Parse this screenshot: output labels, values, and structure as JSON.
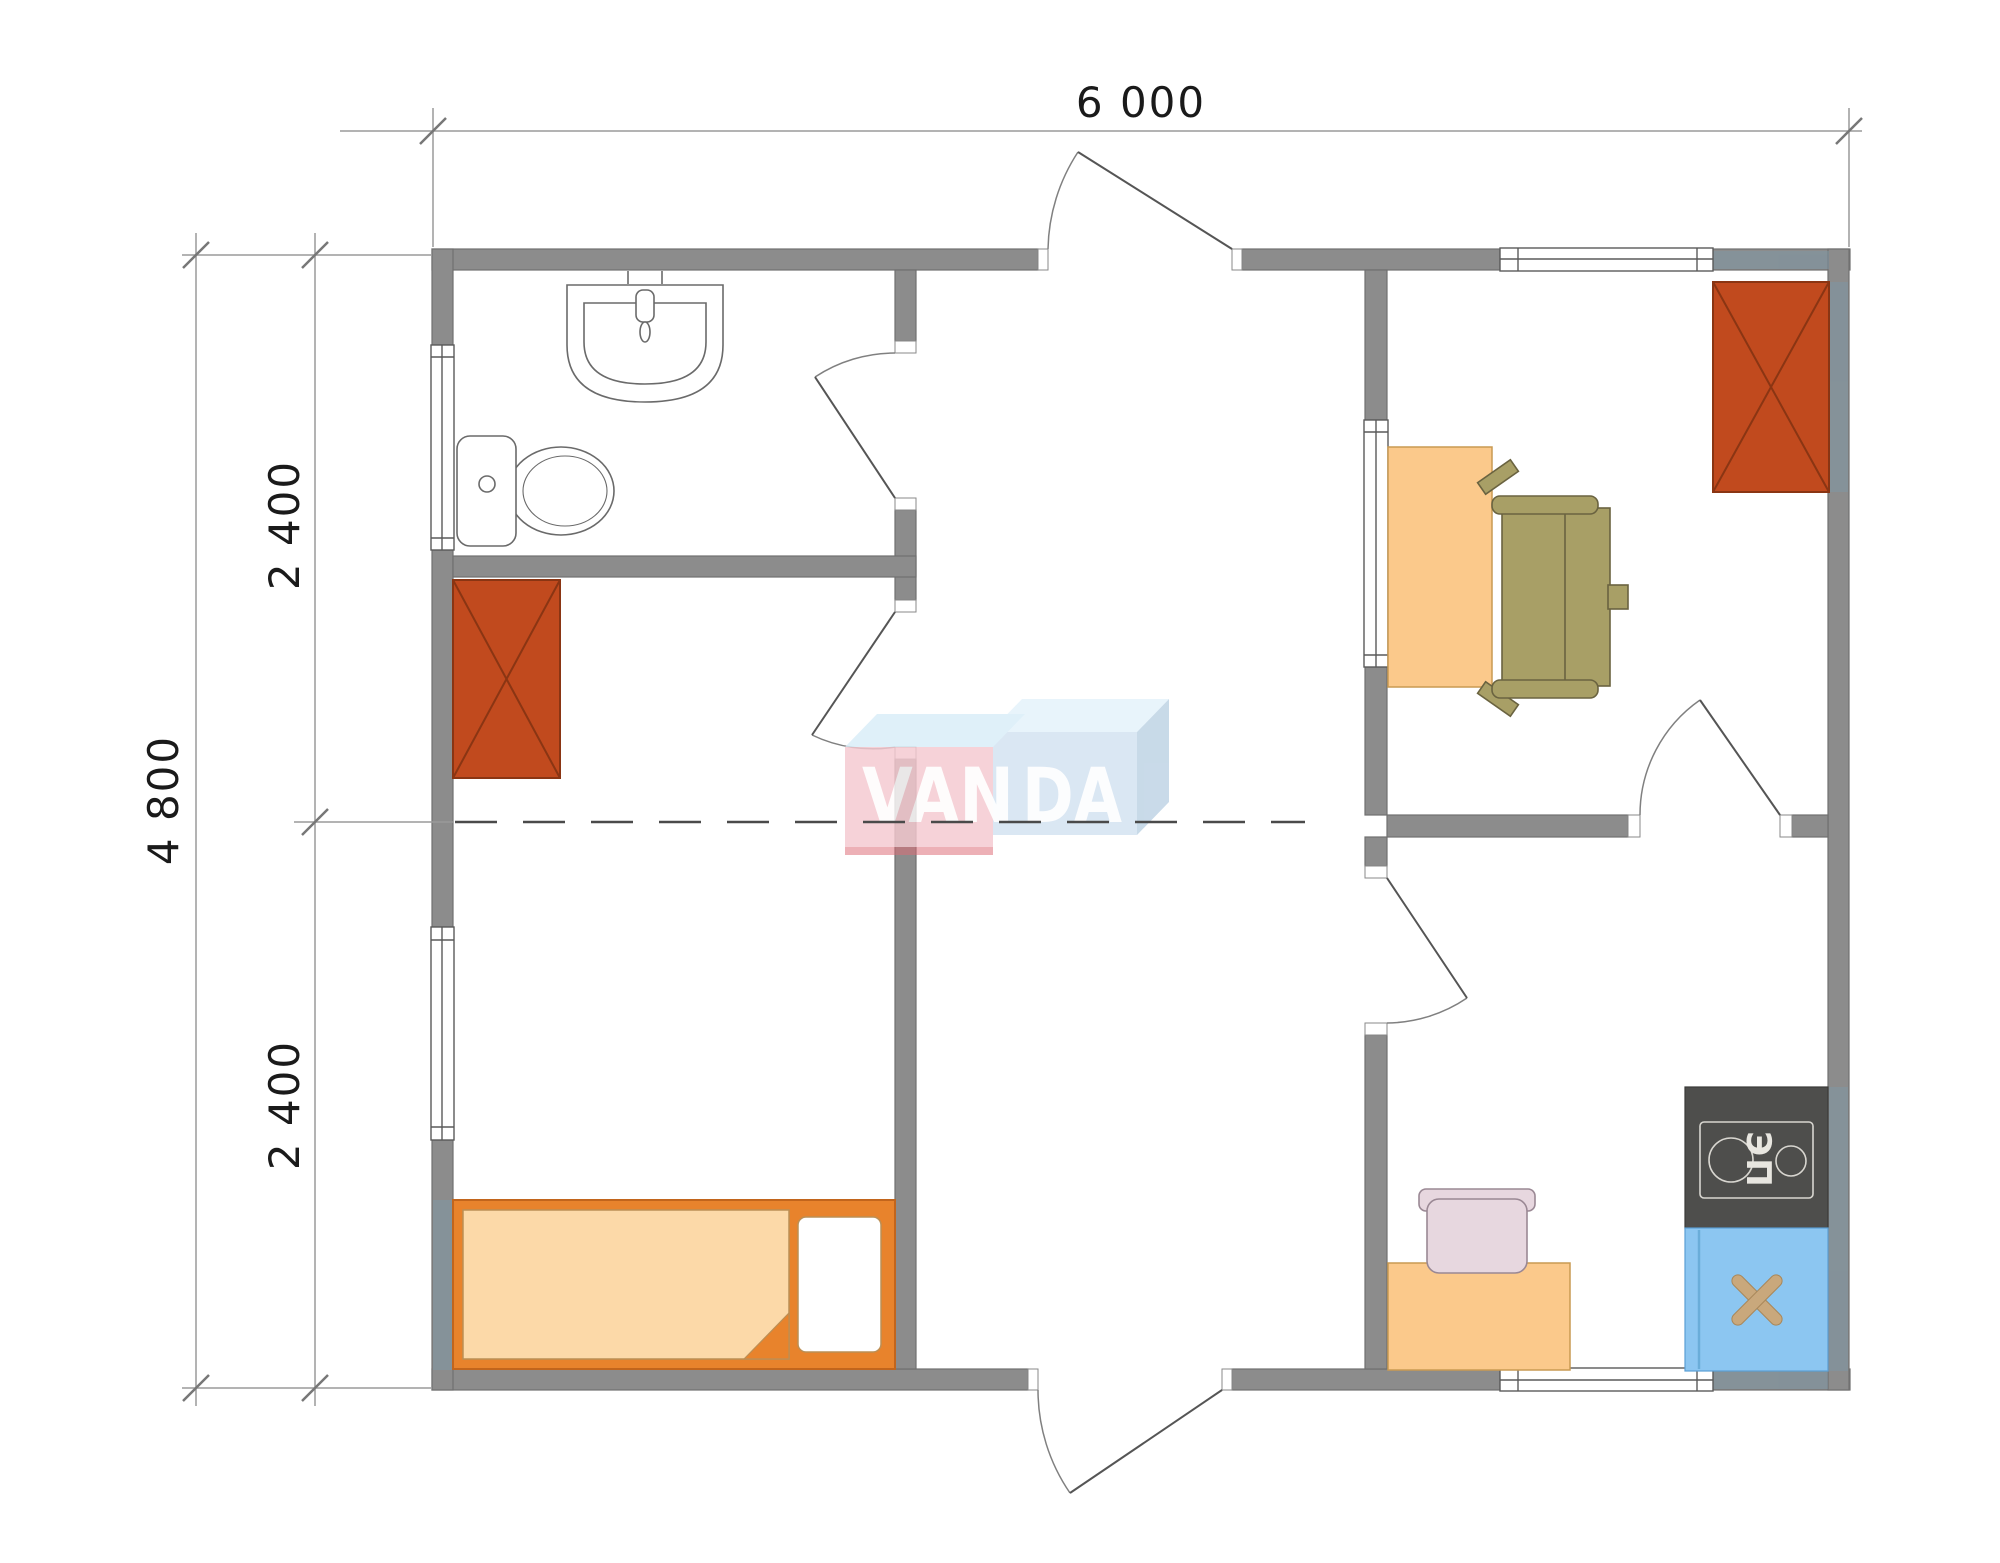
{
  "watermark": {
    "text": "VANDA",
    "part1": "VAN",
    "part2": "DA"
  },
  "dimensions": {
    "top_width": "6 000",
    "left_total": "4 800",
    "left_upper_segment": "2 400",
    "left_lower_segment": "2 400"
  },
  "labels": {
    "stove": "ЭП"
  },
  "colors": {
    "wall": "#8c8c8c",
    "wall_outline": "#707070",
    "window_frame": "#5a5a5a",
    "door_leaf": "#555555",
    "door_arc": "#808080",
    "fixture_line": "#6a6a6a",
    "wardrobe": "#c14a1e",
    "wardrobe_line": "#8a3513",
    "bed_frame": "#e8832c",
    "bed_frame_line": "#c2651c",
    "mattress": "#fcd9a8",
    "mattress_line": "#bb8f55",
    "desk": "#fbc98b",
    "desk_line": "#c99a52",
    "office_chair": "#a89f66",
    "office_chair_line": "#6a6340",
    "kitchen_chair": "#e7d7df",
    "kitchen_chair_line": "#9a8894",
    "stove": "#4e4e4c",
    "stove_line": "#d8d6d0",
    "stove_text": "#e8e6e0",
    "kitchen_sink": "#8cc6f1",
    "kitchen_sink_line": "#5a9fd4",
    "sink_cross": "#c9a87c",
    "logo_pink": "#f5c9d0",
    "logo_pink_bevel": "#d9edf8",
    "logo_pink_shadow": "#dd6b77",
    "logo_blue": "#d3e2f1",
    "logo_blue_bevel": "#e3f2fb",
    "logo_blue_shadow": "#bdd2e4",
    "logo_text": "#ffffff",
    "dim_line": "#9a9a9a",
    "tick": "#777777",
    "dim_text": "#1a1a1a",
    "dash_line": "#4a4a4a",
    "wall_tint": "#7d97a6"
  }
}
